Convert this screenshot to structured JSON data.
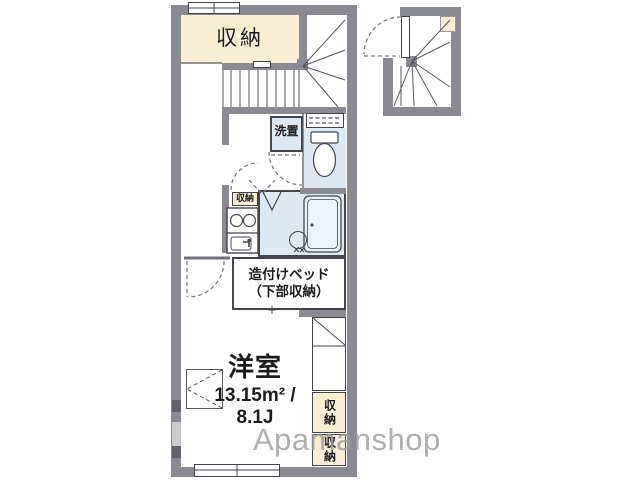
{
  "colors": {
    "wall": "#8a8a92",
    "wall_light": "#c9c9ce",
    "wall_dark": "#62626a",
    "storage_fill": "#f9edd3",
    "wet_area_fill": "#dce9f5",
    "line": "#44444c",
    "watermark": "#9b9b9b"
  },
  "floor_plan": {
    "storage_top": "収納",
    "washer": "洗置",
    "kitchen_storage": "収納",
    "bed_line1": "造付けベッド",
    "bed_line2": "（下部収納）",
    "room_name": "洋室",
    "room_area": "13.15m² /",
    "room_size": "8.1J",
    "storage_right_top": "収納",
    "storage_right_bottom": "収納"
  },
  "watermark": "Apamanshop"
}
